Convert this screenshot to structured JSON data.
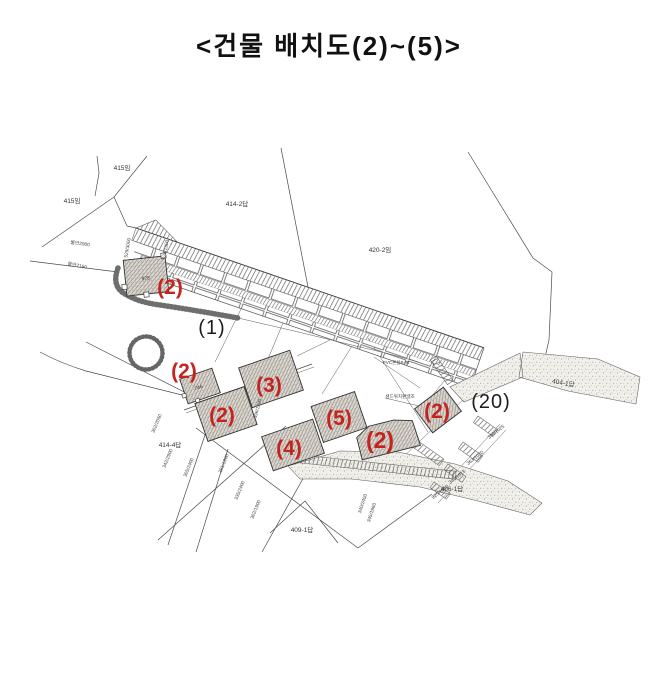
{
  "title": "<건물 배치도(2)~(5)>",
  "plan": {
    "colors": {
      "red_accent": "#c4231e",
      "ink": "#2b2b2b"
    },
    "red": [
      {
        "t": "(2)"
      },
      {
        "t": "(2)"
      },
      {
        "t": "(2)"
      },
      {
        "t": "(3)"
      },
      {
        "t": "(5)"
      },
      {
        "t": "(4)"
      },
      {
        "t": "(2)"
      },
      {
        "t": "(2)"
      }
    ],
    "black": [
      {
        "t": "(1)"
      },
      {
        "t": "(20)"
      }
    ],
    "parcels": [
      {
        "t": "415임"
      },
      {
        "t": "415임"
      },
      {
        "t": "414-2답"
      },
      {
        "t": "420-2임"
      },
      {
        "t": "404-1답"
      },
      {
        "t": "414-4답"
      },
      {
        "t": "409-1답"
      },
      {
        "t": "406-1답"
      }
    ],
    "buildings": [
      {
        "t": "975"
      },
      {
        "t": "746"
      }
    ],
    "specs": [
      {
        "t": "PVC온실B+B"
      },
      {
        "t": "샌드위치판넬조"
      }
    ],
    "survey": [
      {
        "t": "물안2900"
      },
      {
        "t": "물안7160"
      },
      {
        "t": "529/3000"
      },
      {
        "t": "524/1300"
      },
      {
        "t": "302/2050"
      },
      {
        "t": "342/2900"
      },
      {
        "t": "305/2400"
      },
      {
        "t": "381/1900"
      },
      {
        "t": "335/2400"
      },
      {
        "t": "302/1900"
      },
      {
        "t": "396/1300"
      },
      {
        "t": "340/2400"
      },
      {
        "t": "345/1960"
      },
      {
        "t": "384/1025"
      },
      {
        "t": "363/1020"
      },
      {
        "t": "341/1015"
      },
      {
        "t": "325/1010"
      }
    ]
  }
}
